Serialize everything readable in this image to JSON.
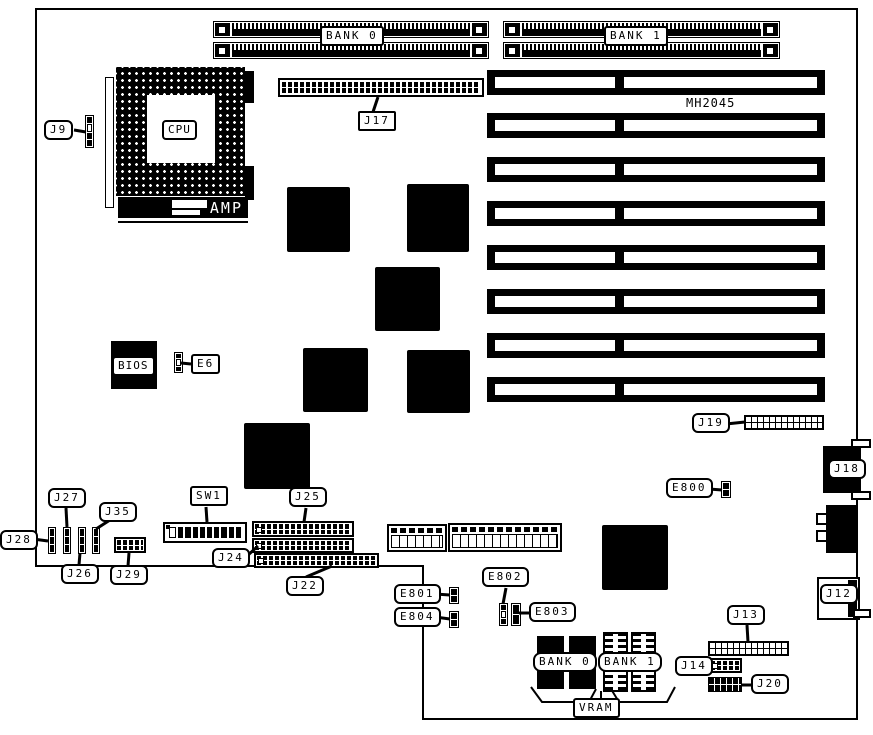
{
  "figure": {
    "background": "#ffffff",
    "ink": "#000000",
    "silkscreen_text": "MH2045",
    "cpu_label": "CPU",
    "amp_label": "AMP",
    "bios_label": "BIOS",
    "memory_banks": {
      "bank0": "BANK 0",
      "bank1": "BANK 1"
    },
    "vram": {
      "bank0": "BANK 0",
      "bank1": "BANK 1",
      "label": "VRAM"
    },
    "connectors": {
      "j9": "J9",
      "j12": "J12",
      "j13": "J13",
      "j14": "J14",
      "j17": "J17",
      "j18": "J18",
      "j19": "J19",
      "j20": "J20",
      "j22": "J22",
      "j24": "J24",
      "j25": "J25",
      "j26": "J26",
      "j27": "J27",
      "j28": "J28",
      "j29": "J29",
      "j35": "J35",
      "sw1": "SW1"
    },
    "jumpers": {
      "e6": "E6",
      "e800": "E800",
      "e801": "E801",
      "e802": "E802",
      "e803": "E803",
      "e804": "E804"
    }
  }
}
